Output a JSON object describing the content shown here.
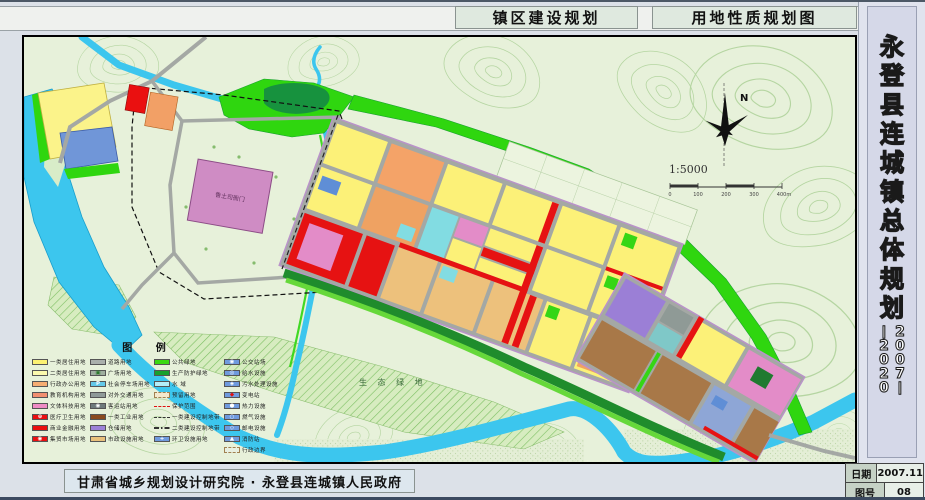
{
  "header": {
    "tab1": "镇区建设规划",
    "tab2": "用地性质规划图"
  },
  "sidebar": {
    "title": "永登县连城镇总体规划",
    "years": "2007——2020",
    "date_label": "日期",
    "date_value": "2007.11",
    "sheet_label": "图号",
    "sheet_value": "08"
  },
  "footer": {
    "credit": "甘肃省城乡规划设计研究院 · 永登县连城镇人民政府"
  },
  "map": {
    "north_label": "N",
    "scale_text": "1:5000",
    "scale_ticks": [
      "0",
      "100",
      "200",
      "300",
      "400m"
    ],
    "labels": {
      "eco_green": "生 态 绿 地",
      "yamen": "鲁土司衙门"
    },
    "colors": {
      "terrain": "#e7f1da",
      "contour": "#afd29b",
      "water": "#3cc6ee",
      "green": "#2fd60f",
      "dark_green": "#17a02e",
      "road": "#a4a8a4",
      "residential": "#fcf178",
      "commercial": "#e61212",
      "industrial": "#a87848"
    },
    "legend": {
      "title": "图  例",
      "columns": [
        [
          {
            "kind": "box",
            "color": "#fcf172",
            "label": "一类居住用地"
          },
          {
            "kind": "box",
            "color": "#fbf9ad",
            "label": "二类居住用地"
          },
          {
            "kind": "box",
            "color": "#f6ad72",
            "label": "行政办公用地"
          },
          {
            "kind": "box",
            "color": "#f28f70",
            "label": "教育机构用地"
          },
          {
            "kind": "box",
            "color": "#ef8cc5",
            "label": "文体科技用地"
          },
          {
            "kind": "box",
            "color": "#ea1010",
            "glyph": "⊕",
            "glyphColor": "#ffffff",
            "label": "医疗卫生用地"
          },
          {
            "kind": "box",
            "color": "#ea1010",
            "label": "商业金融用地"
          },
          {
            "kind": "box",
            "color": "#ea1010",
            "glyph": "◉",
            "glyphColor": "#ffffff",
            "label": "集贸市场用地"
          }
        ],
        [
          {
            "kind": "box",
            "color": "#aab0ac",
            "label": "道路用地"
          },
          {
            "kind": "box",
            "color": "#9fae9f",
            "glyph": "▣",
            "glyphColor": "#2c7a2c",
            "label": "广场用地"
          },
          {
            "kind": "box",
            "color": "#63c8e8",
            "glyph": "P",
            "glyphColor": "#ffffff",
            "label": "社会停车场用地"
          },
          {
            "kind": "box",
            "color": "#8f9a98",
            "label": "对外交通用地"
          },
          {
            "kind": "box",
            "color": "#6e7a7c",
            "glyph": "◉",
            "glyphColor": "#ffffff",
            "label": "客运站用地"
          },
          {
            "kind": "box",
            "color": "#8a4a20",
            "label": "一类工业用地"
          },
          {
            "kind": "box",
            "color": "#9c82d8",
            "label": "仓储用地"
          },
          {
            "kind": "box",
            "color": "#e9c07c",
            "label": "市政设施用地"
          }
        ],
        [
          {
            "kind": "box",
            "color": "#3ad812",
            "label": "公共绿地"
          },
          {
            "kind": "box",
            "color": "#17a02e",
            "label": "生产防护绿地"
          },
          {
            "kind": "box",
            "color": "#b4eef8",
            "label": "水  域"
          },
          {
            "kind": "box-dashed",
            "color": "#f4e9cd",
            "label": "预留用地"
          },
          {
            "kind": "line-dash",
            "color": "#e01010",
            "label": "保护范围"
          },
          {
            "kind": "line-dash",
            "color": "#333333",
            "label": "一类建设控制地带"
          },
          {
            "kind": "line-dashdot",
            "color": "#333333",
            "label": "二类建设控制地带"
          },
          {
            "kind": "box",
            "color": "#6f9ade",
            "glyph": "+",
            "glyphColor": "#ffffff",
            "label": "环卫设施用地"
          }
        ],
        [
          {
            "kind": "box",
            "color": "#6f9ade",
            "glyph": "◉",
            "glyphColor": "#ffffff",
            "label": "公交站场"
          },
          {
            "kind": "box",
            "color": "#6f9ade",
            "glyph": "◎",
            "glyphColor": "#ffffff",
            "label": "给水设施"
          },
          {
            "kind": "box",
            "color": "#6f9ade",
            "glyph": "◈",
            "glyphColor": "#ffffff",
            "label": "污水处理设施"
          },
          {
            "kind": "box",
            "color": "#6f9ade",
            "glyph": "◆",
            "glyphColor": "#e01010",
            "label": "变电站"
          },
          {
            "kind": "box",
            "color": "#6f9ade",
            "glyph": "●",
            "glyphColor": "#ffffff",
            "label": "热力设施"
          },
          {
            "kind": "box",
            "color": "#6f9ade",
            "glyph": "○",
            "glyphColor": "#ffffff",
            "label": "燃气设施"
          },
          {
            "kind": "box",
            "color": "#6f9ade",
            "glyph": "◇",
            "glyphColor": "#ffffff",
            "label": "邮电设施"
          },
          {
            "kind": "box",
            "color": "#6f9ade",
            "glyph": "▲",
            "glyphColor": "#ffffff",
            "label": "消防站"
          },
          {
            "kind": "box-dashed",
            "color": "#e8efe0",
            "label": "行政边界"
          }
        ]
      ]
    }
  }
}
